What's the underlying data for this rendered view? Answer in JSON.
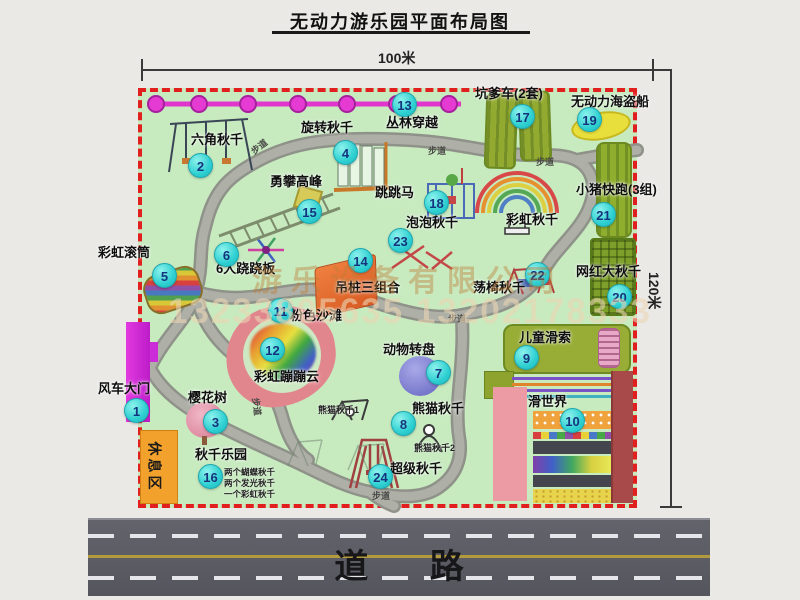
{
  "title": "无动力游乐园平面布局图",
  "dimensions": {
    "width": "100米",
    "height": "120米"
  },
  "road": {
    "label": "道 路"
  },
  "rest_area": {
    "label": "休息区"
  },
  "walkway_label": "步道",
  "rainbow_swing": {
    "label": "彩虹秋千"
  },
  "watermark": {
    "company": "游乐设备有限公司",
    "phones": "13233805635 13202178333"
  },
  "colors": {
    "map_green": "#c7eabf",
    "border_red": "#e21f1f",
    "badge_cyan": "#2fd0d2",
    "magenta": "#e136ce",
    "road_gray": "#5b5b63"
  },
  "attractions": [
    {
      "num": "1",
      "label": "风车大门"
    },
    {
      "num": "2",
      "label": "六角秋千"
    },
    {
      "num": "3",
      "label": "樱花树"
    },
    {
      "num": "4",
      "label": "旋转秋千"
    },
    {
      "num": "5",
      "label": "彩虹滚筒"
    },
    {
      "num": "6",
      "label": "6人跷跷板"
    },
    {
      "num": "7",
      "label": "动物转盘"
    },
    {
      "num": "8",
      "label": "熊猫秋千",
      "sub1": "熊猫秋千1",
      "sub2": "熊猫秋千2"
    },
    {
      "num": "9",
      "label": "儿童滑索"
    },
    {
      "num": "10",
      "label": "滑世界"
    },
    {
      "num": "11",
      "label": "粉色沙滩"
    },
    {
      "num": "12",
      "label": "彩虹蹦蹦云"
    },
    {
      "num": "13",
      "label": "丛林穿越"
    },
    {
      "num": "14",
      "label": "吊桩三组合"
    },
    {
      "num": "15",
      "label": "勇攀高峰"
    },
    {
      "num": "16",
      "label": "秋千乐园",
      "notes": [
        "两个蝴蝶秋千",
        "两个发光秋千",
        "一个彩虹秋千"
      ]
    },
    {
      "num": "17",
      "label": "坑爹车(2套)"
    },
    {
      "num": "18",
      "label": "跳跳马"
    },
    {
      "num": "19",
      "label": "无动力海盗船"
    },
    {
      "num": "20",
      "label": "网红大秋千"
    },
    {
      "num": "21",
      "label": "小猪快跑(3组)"
    },
    {
      "num": "22",
      "label": "荡椅秋千"
    },
    {
      "num": "23",
      "label": "泡泡秋千"
    },
    {
      "num": "24",
      "label": "超级秋千"
    }
  ]
}
